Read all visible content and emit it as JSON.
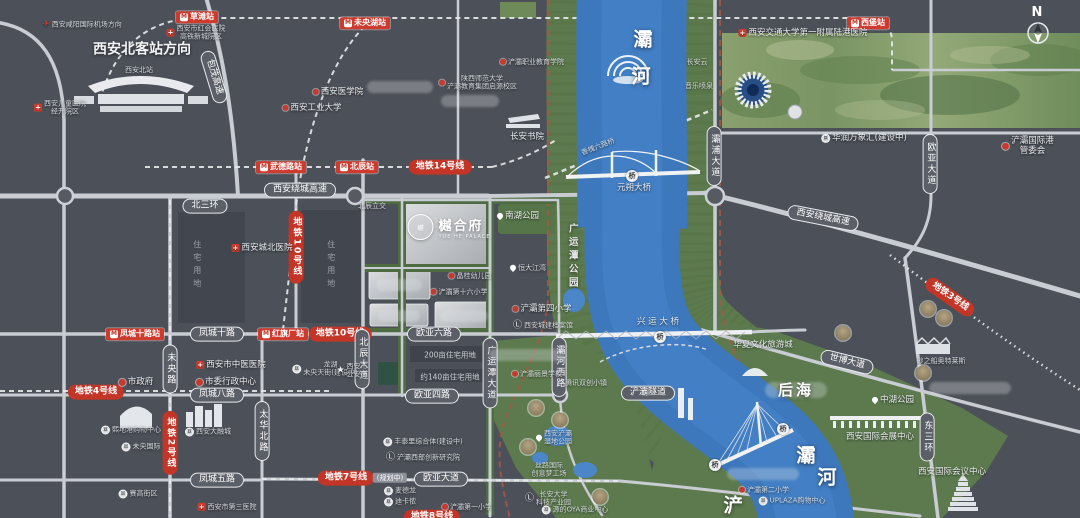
{
  "compass_letter": "N",
  "project": {
    "logo_cn": "樾合府",
    "logo_en": "YUE HE PALACE",
    "logo_mark": "樾"
  },
  "colors": {
    "bg": "#4c5058",
    "road": "#c9cdd3",
    "river": "#3d78bd",
    "green": "#5c7a4e",
    "metro_red": "#c23527",
    "station_red": "#ce3b2e",
    "boundary_red": "#a85744"
  },
  "icons": {
    "metro": {
      "g": "M"
    },
    "hosp": {
      "g": "+"
    },
    "sch": {
      "g": ""
    },
    "govt": {
      "g": ""
    },
    "cart": {
      "g": "¤"
    },
    "edu": {
      "g": "Ⓛ"
    },
    "star": {
      "g": "★"
    },
    "pin": {
      "g": ""
    },
    "plane": {
      "g": "✈"
    }
  },
  "labels": [
    {
      "t": "草滩站",
      "x": 197,
      "y": 17,
      "c": "st",
      "i": "metro",
      "n": "station-caotan"
    },
    {
      "t": "未央湖站",
      "x": 365,
      "y": 23,
      "c": "st",
      "i": "metro",
      "n": "station-weiyanghu"
    },
    {
      "t": "西堡站",
      "x": 868,
      "y": 23,
      "c": "st",
      "i": "metro",
      "n": "station-xibu"
    },
    {
      "t": "武德路站",
      "x": 281,
      "y": 167,
      "c": "st",
      "i": "metro",
      "n": "station-wudelu"
    },
    {
      "t": "北辰站",
      "x": 357,
      "y": 167,
      "c": "st",
      "i": "metro",
      "n": "station-beichen"
    },
    {
      "t": "凤城十路站",
      "x": 135,
      "y": 334,
      "c": "st",
      "i": "metro",
      "n": "station-fengchengshilu"
    },
    {
      "t": "红旗厂站",
      "x": 283,
      "y": 334,
      "c": "st",
      "i": "metro",
      "n": "station-hongqichang"
    },
    {
      "t": "地铁14号线",
      "x": 440,
      "y": 167,
      "c": "ml",
      "n": "metro-line-14"
    },
    {
      "t": "地铁10号线",
      "x": 340,
      "y": 334,
      "c": "ml",
      "n": "metro-line-10"
    },
    {
      "t": "地铁4号线",
      "x": 96,
      "y": 392,
      "c": "ml",
      "n": "metro-line-4"
    },
    {
      "t": "地铁7号线",
      "x": 346,
      "y": 478,
      "c": "ml",
      "n": "metro-line-7"
    },
    {
      "t": "(规划中)",
      "x": 390,
      "y": 478,
      "c": "tag",
      "n": "metro-line-7-planned-tag"
    },
    {
      "t": "地铁3号线",
      "x": 950,
      "y": 297,
      "c": "ml",
      "r": 35,
      "n": "metro-line-3"
    },
    {
      "t": "地铁8号线",
      "x": 432,
      "y": 517,
      "c": "ml",
      "n": "metro-line-8"
    },
    {
      "t": "地铁10号线",
      "x": 296,
      "y": 247,
      "c": "mlv",
      "n": "metro-line-10-vertical"
    },
    {
      "t": "地铁2号线",
      "x": 170,
      "y": 443,
      "c": "mlv",
      "n": "metro-line-2-vertical"
    },
    {
      "t": "北三环",
      "x": 205,
      "y": 206,
      "c": "rd",
      "n": "road-beisanhuan"
    },
    {
      "t": "西安绕城高速",
      "x": 300,
      "y": 190,
      "c": "rd",
      "n": "road-raocheng-west"
    },
    {
      "t": "西安绕城高速",
      "x": 823,
      "y": 218,
      "c": "rd",
      "r": 11,
      "n": "road-raocheng-east"
    },
    {
      "t": "凤城十路",
      "x": 217,
      "y": 334,
      "c": "rd",
      "n": "road-fengcheng10"
    },
    {
      "t": "欧亚六路",
      "x": 434,
      "y": 334,
      "c": "rd",
      "n": "road-ouya6"
    },
    {
      "t": "凤城八路",
      "x": 217,
      "y": 395,
      "c": "rd",
      "n": "road-fengcheng8"
    },
    {
      "t": "欧亚四路",
      "x": 432,
      "y": 396,
      "c": "rd",
      "n": "road-ouya4"
    },
    {
      "t": "凤城五路",
      "x": 217,
      "y": 480,
      "c": "rd",
      "n": "road-fengcheng5"
    },
    {
      "t": "欧亚大道",
      "x": 441,
      "y": 479,
      "c": "rd",
      "n": "road-ouyadadao"
    },
    {
      "t": "包茂高速",
      "x": 214,
      "y": 77,
      "c": "rd",
      "r": 73,
      "n": "road-baomao"
    },
    {
      "t": "世博大道",
      "x": 847,
      "y": 362,
      "c": "rd",
      "r": 14,
      "n": "road-shibo"
    },
    {
      "t": "未央路",
      "x": 170,
      "y": 369,
      "c": "rdv",
      "n": "road-weiyang"
    },
    {
      "t": "太华北路",
      "x": 262,
      "y": 431,
      "c": "rdv",
      "n": "road-taihua"
    },
    {
      "t": "北辰大道",
      "x": 362,
      "y": 359,
      "c": "rdv",
      "n": "road-beichen-avenue"
    },
    {
      "t": "广运潭大道",
      "x": 490,
      "y": 373,
      "c": "rdv",
      "n": "road-guangyuntan-avenue"
    },
    {
      "t": "灞河西路",
      "x": 559,
      "y": 367,
      "c": "rdv",
      "n": "road-bahexilu"
    },
    {
      "t": "灞浦大道",
      "x": 714,
      "y": 156,
      "c": "rdv",
      "n": "road-bapu"
    },
    {
      "t": "欧亚大道",
      "x": 930,
      "y": 164,
      "c": "rdv",
      "n": "road-ouya-north"
    },
    {
      "t": "东三环",
      "x": 927,
      "y": 437,
      "c": "rdv",
      "n": "road-dongsanhuan"
    },
    {
      "t": "西安北客站方向",
      "x": 142,
      "y": 50,
      "c": "bigd",
      "n": "north-station-direction"
    },
    {
      "t": "西安北站",
      "x": 139,
      "y": 70,
      "c": "txs",
      "n": "north-station-caption"
    },
    {
      "t": "灞",
      "x": 643,
      "y": 40,
      "c": "bigc",
      "n": "bahe-char-1"
    },
    {
      "t": "河",
      "x": 641,
      "y": 77,
      "c": "bigc",
      "n": "bahe-char-2"
    },
    {
      "x": 796,
      "y": 390,
      "c": "gh",
      "w": 62,
      "h": 16,
      "n": "houhai-ghost"
    },
    {
      "t": "后海",
      "x": 796,
      "y": 390,
      "c": "big",
      "n": "houhai"
    },
    {
      "t": "灞",
      "x": 806,
      "y": 456,
      "c": "bigc",
      "n": "bahe-lower-char-1"
    },
    {
      "t": "河",
      "x": 827,
      "y": 478,
      "c": "bigc",
      "n": "bahe-lower-char-2"
    },
    {
      "t": "浐",
      "x": 733,
      "y": 506,
      "c": "bigc",
      "n": "chanhe-char"
    },
    {
      "t": "广运潭公园",
      "x": 572,
      "y": 257,
      "c": "txv",
      "n": "guangyuntan-park"
    },
    {
      "t": "西安咸阳国际机场方向",
      "x": 82,
      "y": 25,
      "c": "txs",
      "i": "plane",
      "n": "airport-direction"
    },
    {
      "t": "西安市红会医院\n高铁新城院区",
      "x": 196,
      "y": 33,
      "c": "txs",
      "i": "hosp",
      "n": "honghui-hospital"
    },
    {
      "t": "西安儿童医院\n经开院区",
      "x": 60,
      "y": 108,
      "c": "txs",
      "i": "hosp",
      "n": "children-hospital"
    },
    {
      "t": "西安医学院",
      "x": 338,
      "y": 92,
      "c": "tx",
      "i": "sch",
      "n": "xian-medical-college"
    },
    {
      "t": "西安工业大学",
      "x": 312,
      "y": 108,
      "c": "tx",
      "i": "sch",
      "n": "xian-technological-university"
    },
    {
      "t": "陕西师范大学\n浐灞教育集团启源校区",
      "x": 478,
      "y": 83,
      "c": "txs",
      "i": "sch",
      "n": "shaanxi-normal-university"
    },
    {
      "t": "浐灞职业教育学院",
      "x": 532,
      "y": 62,
      "c": "txs",
      "i": "sch",
      "n": "chanba-vocational-college"
    },
    {
      "t": "长安书院",
      "x": 527,
      "y": 137,
      "c": "tx",
      "n": "changan-academy"
    },
    {
      "t": "长安云",
      "x": 697,
      "y": 62,
      "c": "txs",
      "n": "changan-cloud"
    },
    {
      "t": "音乐喷泉",
      "x": 699,
      "y": 86,
      "c": "txs",
      "n": "music-fountain"
    },
    {
      "t": "西安交通大学第一附属陆港医院",
      "x": 803,
      "y": 33,
      "c": "tx",
      "i": "hosp",
      "n": "jiaotong-hospital"
    },
    {
      "t": "华润万象汇(建设中)",
      "x": 864,
      "y": 138,
      "c": "tx",
      "i": "cart",
      "n": "mixc-mall"
    },
    {
      "t": "浐灞国际港管委会",
      "x": 1028,
      "y": 146,
      "c": "tx",
      "i": "govt",
      "n": "port-admin-committee"
    },
    {
      "t": "N",
      "x": 1037,
      "y": 13,
      "c": "north",
      "n": "compass-letter"
    },
    {
      "t": "西安城北医院",
      "x": 262,
      "y": 248,
      "c": "tx",
      "i": "hosp",
      "n": "chengbei-hospital"
    },
    {
      "t": "北辰立交",
      "x": 372,
      "y": 206,
      "c": "txs",
      "n": "beichen-interchange"
    },
    {
      "t": "住宅用地",
      "x": 197,
      "y": 266,
      "c": "pv",
      "n": "residential-parcel-label-1"
    },
    {
      "t": "住宅用地",
      "x": 331,
      "y": 266,
      "c": "pv",
      "n": "residential-parcel-label-2"
    },
    {
      "t": "南湖公园",
      "x": 518,
      "y": 216,
      "c": "tx",
      "i": "pin",
      "n": "nanhu-park"
    },
    {
      "t": "恒大江湾",
      "x": 528,
      "y": 268,
      "c": "txs",
      "i": "pin",
      "n": "hengda-jiangwan"
    },
    {
      "t": "晶桂幼儿园",
      "x": 470,
      "y": 276,
      "c": "txs",
      "i": "sch",
      "n": "jinggui-kindergarten"
    },
    {
      "t": "浐灞第十六小学",
      "x": 459,
      "y": 292,
      "c": "txs",
      "i": "sch",
      "n": "chanba-16th-primary"
    },
    {
      "t": "浐灞第四小学",
      "x": 542,
      "y": 309,
      "c": "tx",
      "i": "sch",
      "n": "chanba-4th-primary"
    },
    {
      "t": "西安城建档案馆",
      "x": 543,
      "y": 326,
      "c": "txs",
      "i": "edu",
      "n": "urban-archives"
    },
    {
      "t": "浐灞丽景学校",
      "x": 537,
      "y": 374,
      "c": "txs",
      "i": "sch",
      "n": "chanba-lijing-school"
    },
    {
      "t": "腾讯双创小镇",
      "x": 586,
      "y": 383,
      "c": "txs",
      "n": "tencent-town"
    },
    {
      "t": "浐灞隧道",
      "x": 648,
      "y": 393,
      "c": "rd",
      "n": "chanba-tunnel"
    },
    {
      "t": "兴 运 大 桥",
      "x": 658,
      "y": 322,
      "c": "tx",
      "n": "xingyun-bridge-label"
    },
    {
      "t": "元朔大桥",
      "x": 634,
      "y": 188,
      "c": "tx",
      "n": "yuanshuo-bridge-label"
    },
    {
      "t": "香槐六路桥",
      "x": 598,
      "y": 147,
      "c": "txs",
      "r": -21,
      "n": "xianghuai-bridge-label"
    },
    {
      "t": "华夏文化旅游城",
      "x": 763,
      "y": 345,
      "c": "tx",
      "n": "huaxia-culture-city"
    },
    {
      "t": "中湖公园",
      "x": 893,
      "y": 400,
      "c": "tx",
      "i": "pin",
      "n": "zhonghu-park"
    },
    {
      "t": "西安国际会展中心",
      "x": 880,
      "y": 437,
      "c": "tx",
      "n": "intl-convention-exhibition-center"
    },
    {
      "t": "西安国际会议中心",
      "x": 952,
      "y": 472,
      "c": "tx",
      "n": "intl-conference-center"
    },
    {
      "t": "砂之船奥特莱斯",
      "x": 941,
      "y": 361,
      "c": "txs",
      "n": "sasseur-outlets"
    },
    {
      "t": "浐灞第二小学",
      "x": 764,
      "y": 490,
      "c": "txs",
      "i": "sch",
      "n": "chanba-2nd-primary"
    },
    {
      "t": "UPLAZA购物中心",
      "x": 792,
      "y": 501,
      "c": "txs",
      "i": "cart",
      "n": "uplaza-mall"
    },
    {
      "t": "西安浐灞\n湿地公园",
      "x": 554,
      "y": 438,
      "c": "txs",
      "i": "pin",
      "n": "chanba-wetland-park"
    },
    {
      "t": "丝路国际\n创意梦工场",
      "x": 549,
      "y": 470,
      "c": "txs",
      "n": "silkroad-dream-works"
    },
    {
      "t": "长安大学\n科技产业园",
      "x": 548,
      "y": 499,
      "c": "txs",
      "i": "edu",
      "n": "changan-univ-tech-park"
    },
    {
      "t": "源的OYA商业中心",
      "x": 575,
      "y": 510,
      "c": "txs",
      "i": "cart",
      "n": "oya-commercial-center"
    },
    {
      "t": "麦德龙",
      "x": 400,
      "y": 491,
      "c": "txs",
      "i": "cart",
      "n": "metro-market"
    },
    {
      "t": "迪卡侬",
      "x": 400,
      "y": 502,
      "c": "txs",
      "i": "cart",
      "n": "decathlon"
    },
    {
      "t": "浐灞第一小学",
      "x": 467,
      "y": 507,
      "c": "txs",
      "i": "sch",
      "n": "chanba-1st-primary"
    },
    {
      "t": "丰泰里综合体(建设中)",
      "x": 423,
      "y": 442,
      "c": "txs",
      "i": "cart",
      "n": "fengtaili-complex"
    },
    {
      "t": "浐灞西部创新研究院",
      "x": 423,
      "y": 458,
      "c": "txs",
      "i": "edu",
      "n": "west-innovation-institute"
    },
    {
      "t": "龙湖\n未央天街(建设中)",
      "x": 325,
      "y": 369,
      "c": "txs",
      "i": "cart",
      "n": "longfor-paradise-walk"
    },
    {
      "t": "西安市\n公安局",
      "x": 352,
      "y": 371,
      "c": "txs",
      "i": "star",
      "n": "public-security-bureau"
    },
    {
      "t": "市政府",
      "x": 136,
      "y": 382,
      "c": "tx",
      "i": "govt",
      "n": "city-government"
    },
    {
      "t": "市委行政中心",
      "x": 226,
      "y": 382,
      "c": "tx",
      "i": "govt",
      "n": "municipal-admin-center"
    },
    {
      "t": "西安市中医医院",
      "x": 231,
      "y": 365,
      "c": "tx",
      "i": "hosp",
      "n": "tcm-hospital"
    },
    {
      "t": "熙地港购物中心",
      "x": 131,
      "y": 430,
      "c": "txs",
      "i": "cart",
      "n": "xidigang-mall"
    },
    {
      "t": "西安大融城",
      "x": 208,
      "y": 432,
      "c": "txs",
      "i": "cart",
      "n": "darongcheng-mall"
    },
    {
      "t": "未央国际",
      "x": 141,
      "y": 447,
      "c": "txs",
      "i": "cart",
      "n": "weiyang-international"
    },
    {
      "t": "赛高街区",
      "x": 138,
      "y": 494,
      "c": "txs",
      "i": "cart",
      "n": "saige-block"
    },
    {
      "t": "西安市第三医院",
      "x": 227,
      "y": 507,
      "c": "txs",
      "i": "hosp",
      "n": "third-hospital"
    },
    {
      "t": "200亩住宅用地",
      "x": 450,
      "y": 355,
      "c": "pt",
      "n": "parcel-200mu"
    },
    {
      "t": "约140亩住宅用地",
      "x": 450,
      "y": 377,
      "c": "pt",
      "n": "parcel-140mu"
    },
    {
      "t": "桥",
      "x": 632,
      "y": 176,
      "c": "bb",
      "n": "bridge-badge-yuanshuo"
    },
    {
      "t": "桥",
      "x": 660,
      "y": 337,
      "c": "bb",
      "n": "bridge-badge-xingyun"
    },
    {
      "t": "桥",
      "x": 783,
      "y": 429,
      "c": "bb",
      "n": "bridge-badge-cable"
    },
    {
      "t": "桥",
      "x": 715,
      "y": 465,
      "c": "bb",
      "n": "bridge-badge-south"
    },
    {
      "x": 400,
      "y": 87,
      "c": "gh",
      "w": 66,
      "n": "ghost-label-1"
    },
    {
      "x": 470,
      "y": 101,
      "c": "gh",
      "w": 58,
      "n": "ghost-label-2"
    },
    {
      "x": 527,
      "y": 355,
      "c": "gh",
      "w": 76,
      "n": "ghost-label-3"
    },
    {
      "x": 763,
      "y": 474,
      "c": "gh",
      "w": 72,
      "n": "ghost-label-4"
    },
    {
      "x": 970,
      "y": 388,
      "c": "gh",
      "w": 82,
      "n": "ghost-label-5"
    },
    {
      "x": 399,
      "y": 285,
      "c": "gh",
      "w": 46,
      "n": "ghost-parcel-label-1"
    },
    {
      "x": 399,
      "y": 316,
      "c": "gh",
      "w": 42,
      "n": "ghost-parcel-label-2"
    },
    {
      "x": 464,
      "y": 316,
      "c": "gh",
      "w": 48,
      "n": "ghost-parcel-label-3"
    },
    {
      "x": 536,
      "y": 408,
      "c": "med",
      "n": "landmark-medallion-1"
    },
    {
      "x": 560,
      "y": 420,
      "c": "med",
      "n": "landmark-medallion-2"
    },
    {
      "x": 528,
      "y": 447,
      "c": "med",
      "n": "landmark-medallion-3"
    },
    {
      "x": 600,
      "y": 497,
      "c": "med",
      "n": "landmark-medallion-4"
    },
    {
      "x": 928,
      "y": 309,
      "c": "med",
      "n": "landmark-medallion-5"
    },
    {
      "x": 944,
      "y": 318,
      "c": "med",
      "n": "landmark-medallion-6"
    },
    {
      "x": 923,
      "y": 373,
      "c": "med",
      "n": "landmark-medallion-7"
    },
    {
      "x": 843,
      "y": 333,
      "c": "med",
      "n": "landmark-medallion-8"
    }
  ]
}
